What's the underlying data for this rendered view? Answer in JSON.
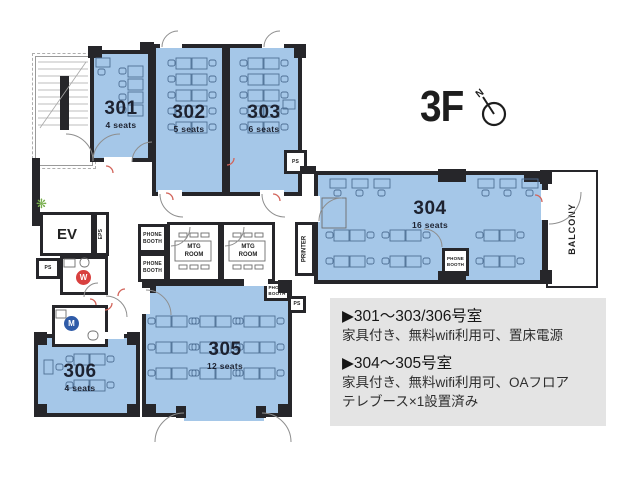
{
  "title": {
    "floor": "3F",
    "compass_n": "N"
  },
  "rooms": [
    {
      "number": "301",
      "seats": "4 seats"
    },
    {
      "number": "302",
      "seats": "5 seats"
    },
    {
      "number": "303",
      "seats": "6 seats"
    },
    {
      "number": "304",
      "seats": "16 seats"
    },
    {
      "number": "305",
      "seats": "12 seats"
    },
    {
      "number": "306",
      "seats": "4 seats"
    }
  ],
  "facilities": {
    "ev": "EV",
    "eps": "EPS",
    "ps": "PS",
    "printer": "PRINTER",
    "balcony": "BALCONY",
    "phone_booth": "PHONE BOOTH",
    "mtg_room": "MTG ROOM",
    "womens": "W",
    "mens": "M"
  },
  "notes": {
    "heading1": "▶301〜303/306号室",
    "body1": "家具付き、無料wifi利用可、置床電源",
    "heading2": "▶304〜305号室",
    "body2": "家具付き、無料wifi利用可、OAフロア",
    "body3": "テレブース×1設置済み"
  }
}
